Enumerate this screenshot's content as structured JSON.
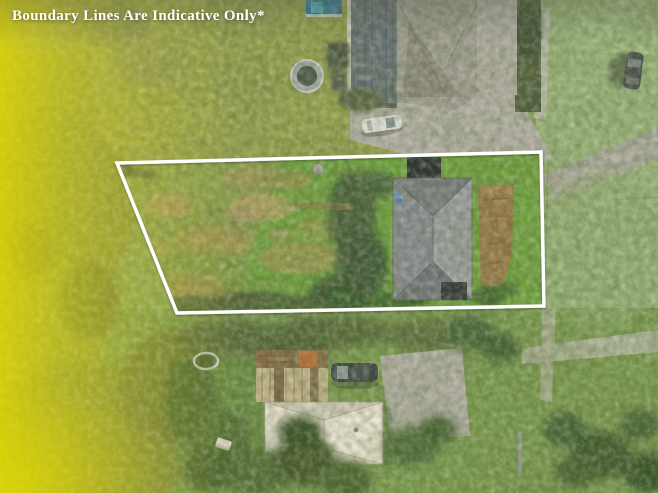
{
  "overlay": {
    "disclaimer": "Boundary Lines Are Indicative Only*"
  },
  "palette": {
    "boundary_line": "#ffffff",
    "tint_yellow": "#e0d716",
    "grass_base": "#8ca85a",
    "field_green": "#9db77d",
    "lot_grass": "#8ba150",
    "lot_green_grass": "#70a741",
    "dry_grass": "#ae9c58",
    "main_roof_gray": "#8a8e93",
    "neighbor_roof_gray": "#a3a097",
    "cream_roof": "#eae4d3",
    "concrete": "#b6b3aa",
    "shadow_green": "#4e6137"
  }
}
